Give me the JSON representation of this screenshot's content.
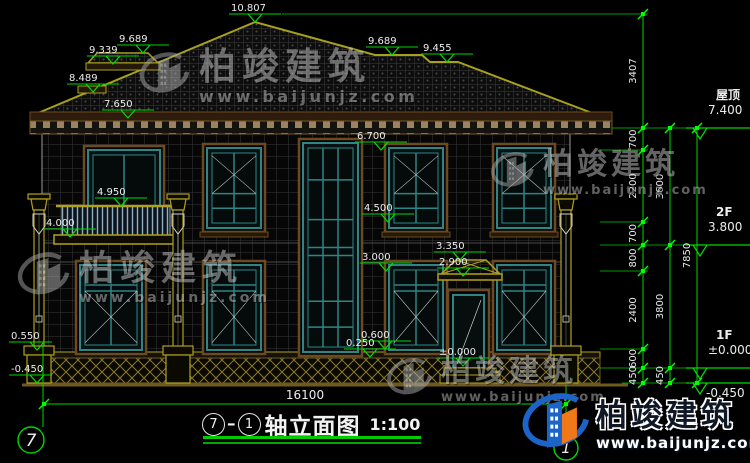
{
  "drawing_type": "建筑立面图",
  "title_block": {
    "axis_from": "7",
    "axis_to": "1",
    "title": "轴立面图",
    "scale": "1:100"
  },
  "axis_bubbles": {
    "left": "7",
    "right": "1"
  },
  "bottom_dimension": {
    "value": "16100"
  },
  "watermark": {
    "brand": "柏竣建筑",
    "url": "www.baijunjz.com"
  },
  "logo": {
    "brand": "柏竣建筑",
    "url": "www.baijunjz.com"
  },
  "elevation_markers": [
    {
      "label": "10.807",
      "x": 255,
      "t": 22
    },
    {
      "label": "9.689",
      "x": 143,
      "t": 53
    },
    {
      "label": "9.339",
      "x": 113,
      "t": 64
    },
    {
      "label": "8.489",
      "x": 93,
      "t": 92
    },
    {
      "label": "7.650",
      "x": 128,
      "t": 118
    },
    {
      "label": "9.689",
      "x": 392,
      "t": 55
    },
    {
      "label": "9.455",
      "x": 447,
      "t": 62
    },
    {
      "label": "6.700",
      "x": 381,
      "t": 150
    },
    {
      "label": "4.950",
      "x": 121,
      "t": 206
    },
    {
      "label": "4.000",
      "x": 70,
      "t": 237
    },
    {
      "label": "4.500",
      "x": 388,
      "t": 222
    },
    {
      "label": "3.350",
      "x": 460,
      "t": 260
    },
    {
      "label": "2.900",
      "x": 463,
      "t": 276
    },
    {
      "label": "3.000",
      "x": 386,
      "t": 271
    },
    {
      "label": "0.600",
      "x": 385,
      "t": 349
    },
    {
      "label": "0.250",
      "x": 370,
      "t": 357
    },
    {
      "label": "±0.000",
      "x": 463,
      "t": 366
    }
  ],
  "left_markers": [
    {
      "label": "0.550",
      "t": 350
    },
    {
      "label": "-0.450",
      "t": 383
    }
  ],
  "right_levels": [
    {
      "name": "屋顶",
      "value": "7.400",
      "t": 128
    },
    {
      "name": "2F",
      "value": "3.800",
      "t": 245
    },
    {
      "name": "1F",
      "value": "±0.000",
      "t": 368
    },
    {
      "name": "",
      "value": "-0.450",
      "t": 383,
      "below": true
    }
  ],
  "dim_chains": [
    {
      "x": 643,
      "ticks": [
        14,
        128,
        150,
        222,
        245,
        271,
        349,
        368,
        383
      ],
      "labels": [
        "3407",
        "700",
        "2200",
        "700",
        "800",
        "2400",
        "600",
        "450"
      ]
    },
    {
      "x": 670,
      "ticks": [
        128,
        245,
        368,
        383
      ],
      "labels": [
        "3600",
        "3800",
        "450"
      ]
    },
    {
      "x": 697,
      "ticks": [
        128,
        383
      ],
      "labels": [
        "7850"
      ]
    }
  ],
  "extension_lines": [
    {
      "y": 14,
      "x1": 282,
      "x2": 648
    },
    {
      "y": 128,
      "x1": 612,
      "x2": 712
    },
    {
      "y": 150,
      "x1": 600,
      "x2": 648
    },
    {
      "y": 222,
      "x1": 600,
      "x2": 648
    },
    {
      "y": 245,
      "x1": 600,
      "x2": 712
    },
    {
      "y": 271,
      "x1": 600,
      "x2": 648
    },
    {
      "y": 349,
      "x1": 600,
      "x2": 648
    },
    {
      "y": 368,
      "x1": 600,
      "x2": 712
    },
    {
      "y": 383,
      "x1": 622,
      "x2": 712
    }
  ],
  "colors": {
    "annotation_green": "#00d800",
    "bright_green": "#00ff00",
    "dim_text": "#ececec",
    "window_teal": "#2f8585",
    "trim_brown": "#6b4a22",
    "structure_olive": "#b0a020",
    "logo_blue": "#1c64c8",
    "logo_orange": "#f07818",
    "watermark_gray": "#c8c8c8"
  }
}
